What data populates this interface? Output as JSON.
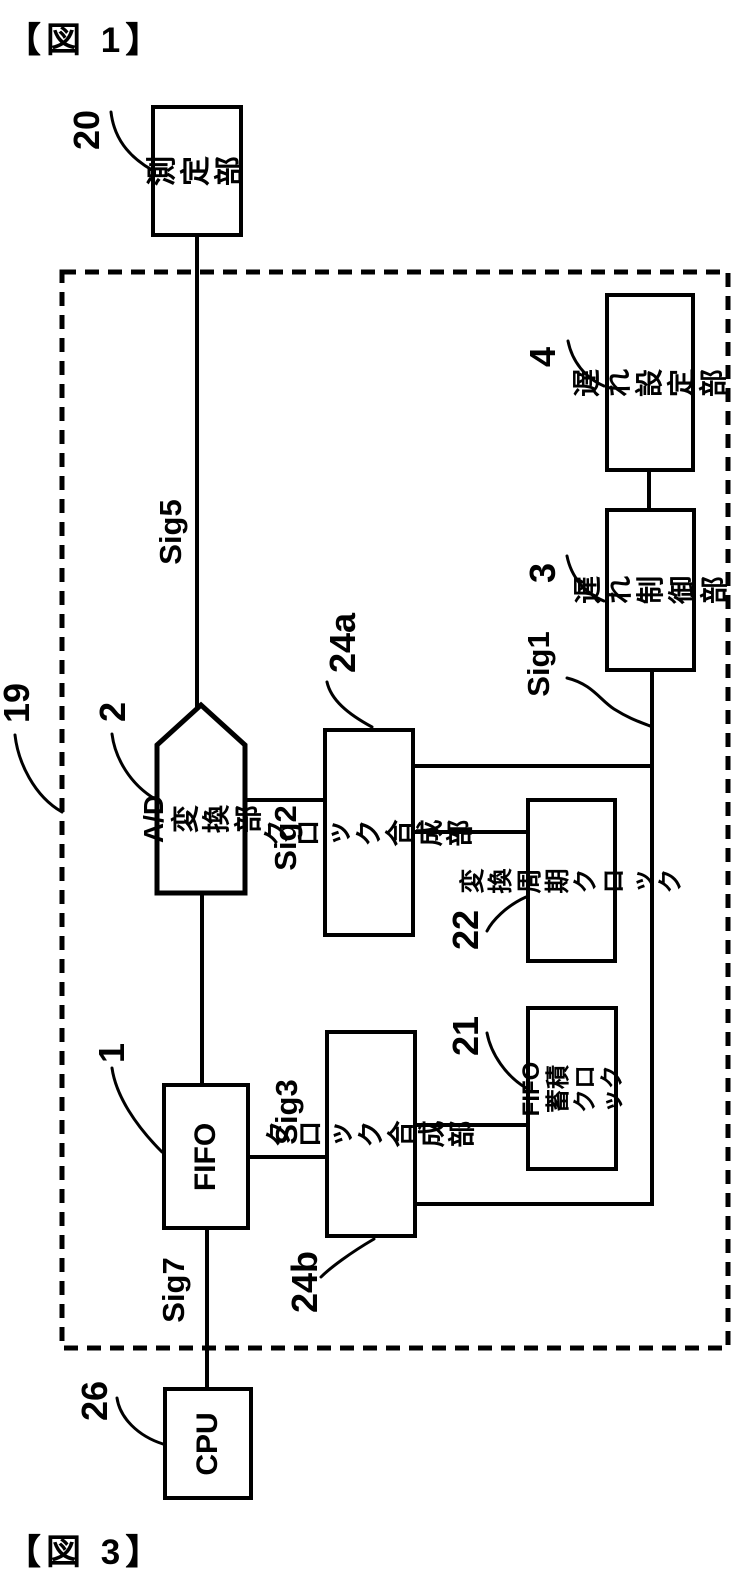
{
  "figure_titles": {
    "top": "【図 1】",
    "bottom": "【図 3】"
  },
  "colors": {
    "ink": "#000000",
    "paper": "#ffffff"
  },
  "outer_dashed_box": {
    "ref": "19"
  },
  "blocks": {
    "measurement": {
      "ref": "20",
      "label": "測定部"
    },
    "ad_converter": {
      "ref": "2",
      "label": "A/D\n変換部"
    },
    "fifo": {
      "ref": "1",
      "label": "FIFO"
    },
    "cpu": {
      "ref": "26",
      "label": "CPU"
    },
    "clock_synth_a": {
      "ref": "24a",
      "label": "クロック\n合成部"
    },
    "clock_synth_b": {
      "ref": "24b",
      "label": "クロック\n合成部"
    },
    "conversion_period_clock": {
      "ref": "22",
      "label": "変換周期\nクロック"
    },
    "fifo_storage_clock": {
      "ref": "21",
      "label": "FIFO蓄積\nクロック"
    },
    "delay_control": {
      "ref": "3",
      "label": "遅れ\n制御部"
    },
    "delay_setting": {
      "ref": "4",
      "label": "遅れ\n設定部"
    }
  },
  "signal_labels": {
    "sig1": "Sig1",
    "sig2": "Sig2",
    "sig3": "Sig3",
    "sig5": "Sig5",
    "sig7": "Sig7"
  }
}
